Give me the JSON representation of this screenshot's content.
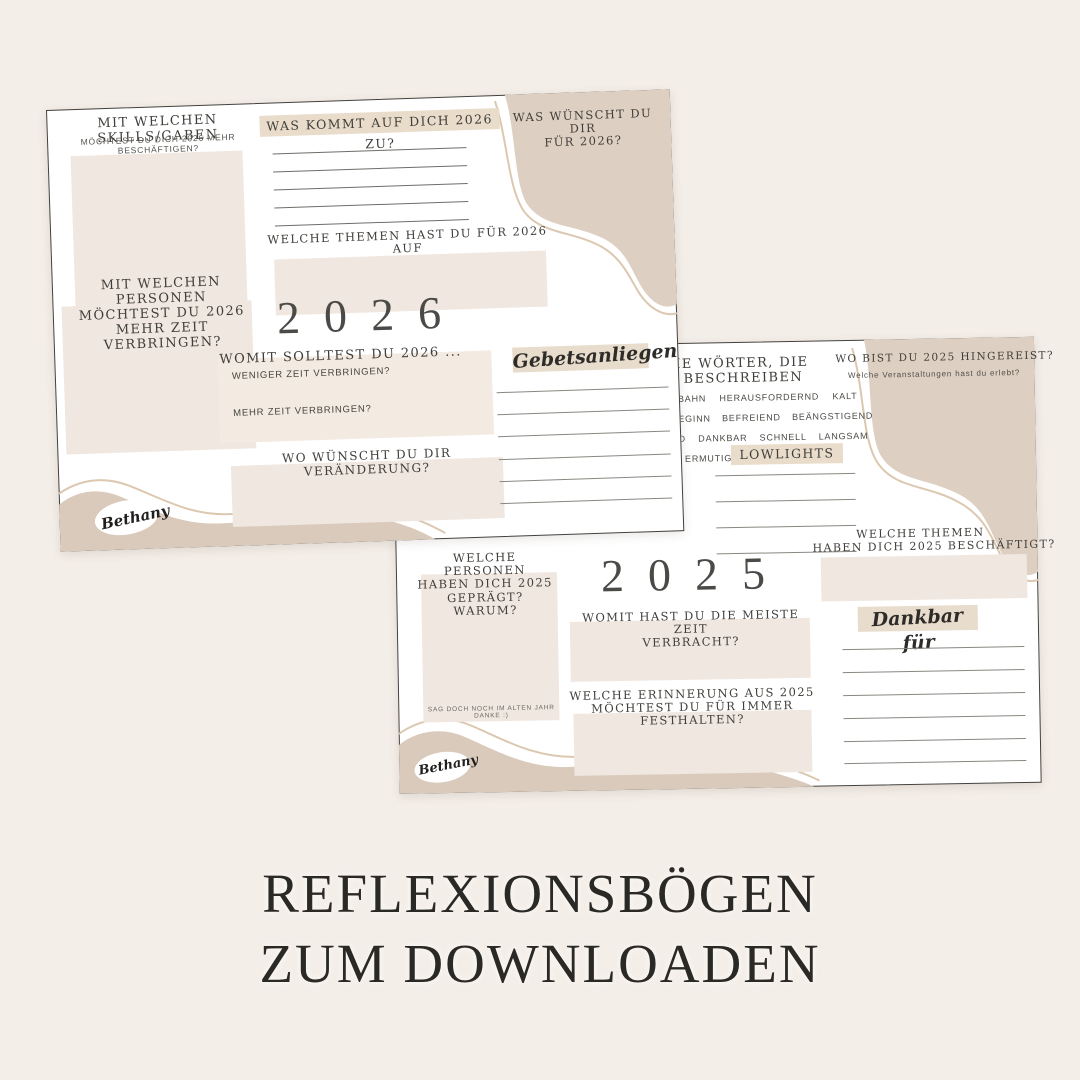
{
  "page": {
    "background": "#f4eee8",
    "title_line1": "REFLEXIONSBÖGEN",
    "title_line2": "ZUM DOWNLOADEN"
  },
  "colors": {
    "sheet_bg": "#ffffff",
    "box_beige": "#f0e7e0",
    "highlight_beige": "#e9dccb",
    "blob_beige": "#ddcfc1",
    "wave_beige": "#d9cabb",
    "outline_beige": "#dcc8b0",
    "heading_dark": "#403e3a",
    "title_dark": "#2b2925"
  },
  "sheet_2026": {
    "year": "2026",
    "skills": {
      "heading": "MIT WELCHEN SKILLS/GABEN",
      "sub": "MÖCHTEST DU DICH 2026 MEHR BESCHÄFTIGEN?"
    },
    "come": {
      "heading": "WAS KOMMT AUF DICH 2026 ZU?"
    },
    "themes": {
      "heading_l1": "WELCHE THEMEN HAST DU FÜR 2026 AUF",
      "heading_l2": "DEM HERZEN?"
    },
    "wish": {
      "heading_l1": "WAS WÜNSCHT DU DIR",
      "heading_l2": "FÜR 2026?"
    },
    "persons": {
      "heading_l1": "MIT WELCHEN PERSONEN",
      "heading_l2": "MÖCHTEST DU 2026",
      "heading_l3": "MEHR ZEIT VERBRINGEN?"
    },
    "womit": {
      "heading": "WOMIT SOLLTEST DU 2026 ...",
      "q1": "WENIGER ZEIT VERBRINGEN?",
      "q2": "MEHR ZEIT VERBRINGEN?"
    },
    "change": {
      "heading": "WO WÜNSCHT DU DIR VERÄNDERUNG?"
    },
    "prayer": {
      "label": "Gebetsanliegen"
    },
    "signature": "Bethany"
  },
  "sheet_2025": {
    "year": "2025",
    "words": {
      "heading_l1": "IE WÖRTER, DIE",
      "heading_l2": "BESCHREIBEN",
      "row1": "BAHN HERAUSFORDERND KALT",
      "row2": "EGINN BEFREIEND BEÄNGSTIGEND",
      "row3": "D DANKBAR SCHNELL LANGSAM",
      "row4": "ERMUTIGEND"
    },
    "travel": {
      "heading": "WO BIST DU 2025 HINGEREIST?",
      "sub": "Welche Veranstaltungen hast du erlebt?"
    },
    "lowlights": {
      "label": "LOWLIGHTS"
    },
    "persons": {
      "heading_l1": "WELCHE PERSONEN",
      "heading_l2": "HABEN DICH 2025",
      "heading_l3": "GEPRÄGT? WARUM?",
      "note": "SAG DOCH NOCH IM ALTEN JAHR DANKE :)"
    },
    "time": {
      "heading_l1": "WOMIT HAST DU DIE MEISTE ZEIT",
      "heading_l2": "VERBRACHT?"
    },
    "memory": {
      "heading_l1": "WELCHE ERINNERUNG AUS 2025",
      "heading_l2": "MÖCHTEST DU FÜR IMMER",
      "heading_l3": "FESTHALTEN?"
    },
    "themes": {
      "heading_l1": "WELCHE THEMEN",
      "heading_l2": "HABEN DICH 2025 BESCHÄFTIGT?"
    },
    "grateful": {
      "label": "Dankbar für"
    },
    "signature": "Bethany"
  }
}
